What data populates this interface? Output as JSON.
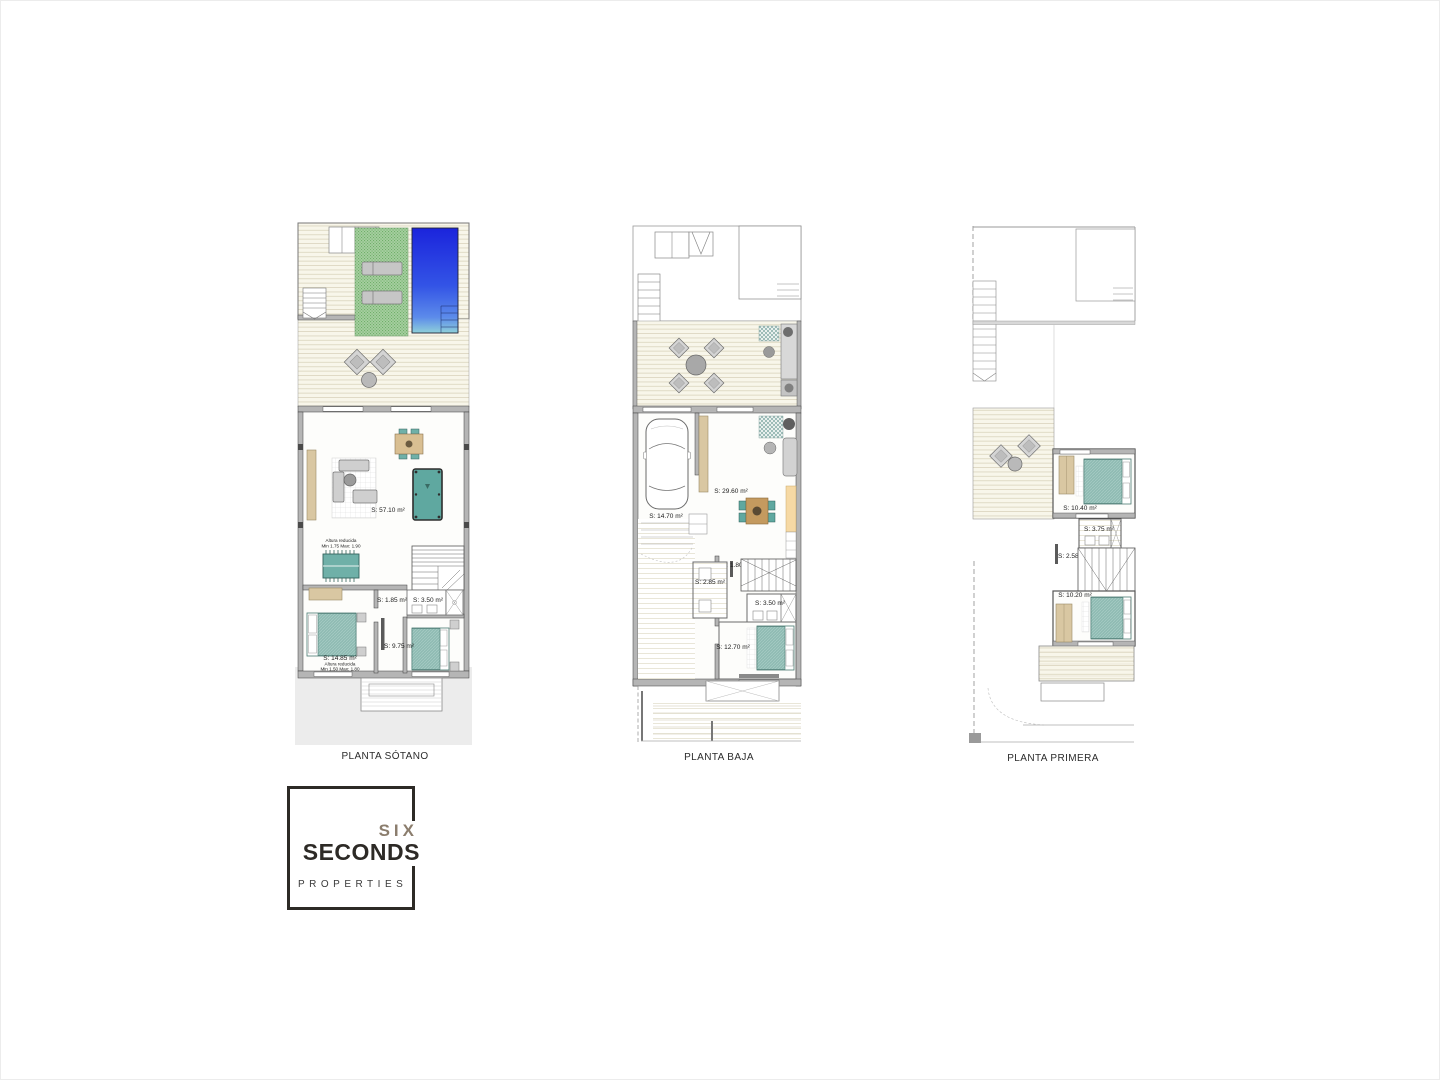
{
  "plans": [
    {
      "id": "sotano",
      "caption": "PLANTA SÓTANO",
      "labels": {
        "main_room": "S: 57.10 m²",
        "altura_main_1": "Altura reducida",
        "altura_main_2": "Min 1.75 Max: 1.90",
        "hall": "S: 1.85 m²",
        "bath": "S: 3.50 m²",
        "bedroom_right": "S: 9.75 m²",
        "bedroom_left": "S: 14.85 m²",
        "altura_bed_1": "Altura reducida",
        "altura_bed_2": "Min 1.50 Max: 1.80"
      }
    },
    {
      "id": "baja",
      "caption": "PLANTA BAJA",
      "labels": {
        "garage": "S: 14.70 m²",
        "living": "S: 29.60 m²",
        "entry": "S: 1.80 m²",
        "laundry": "S: 2.85 m²",
        "bath": "S: 3.50 m²",
        "bedroom": "S: 12.70 m²"
      }
    },
    {
      "id": "primera",
      "caption": "PLANTA PRIMERA",
      "labels": {
        "bedroom_top": "S: 10.40 m²",
        "bath": "S: 3.75 m²",
        "hall": "S: 2.58 m²",
        "bedroom_bottom": "S: 10.20 m²"
      }
    }
  ],
  "logo": {
    "line1": "SIX",
    "line2": "SECONDS",
    "line3": "PROPERTIES"
  },
  "colors": {
    "pool_top": "#1b24dc",
    "pool_bottom": "#8fd0da",
    "grass": "#a6cfa0",
    "furniture_teal": "#6fb0a8",
    "wood_tan": "#d9c7a2",
    "wall_gray": "#b5b5b5",
    "deck_line": "#ddd8c2"
  }
}
